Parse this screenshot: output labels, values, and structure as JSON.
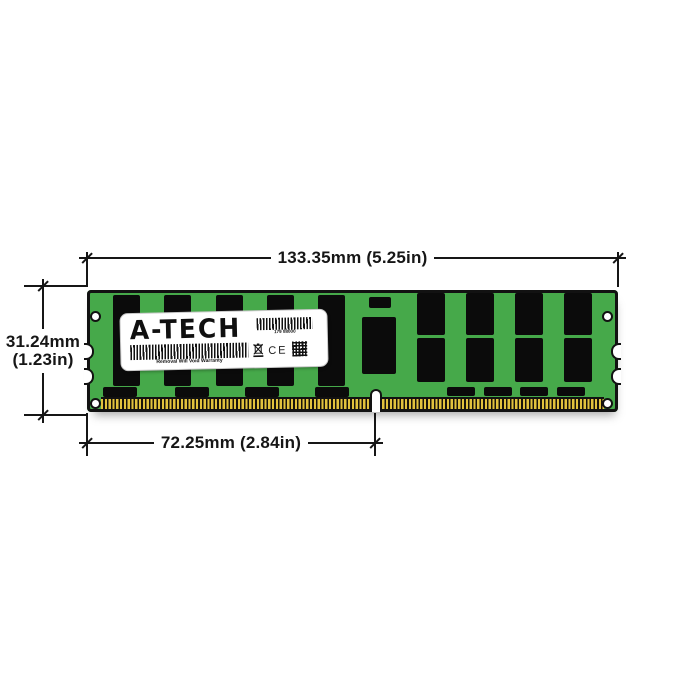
{
  "diagram": {
    "brand_logo": "A-TECH",
    "label": {
      "serial": "179 88000",
      "warning": "Removal Will Void Warranty",
      "ce_mark": "CE"
    },
    "dimensions": {
      "width_label": "133.35mm (5.25in)",
      "height_label_mm": "31.24mm",
      "height_label_in": "(1.23in)",
      "pin_offset_label": "72.25mm (2.84in)"
    },
    "colors": {
      "pcb_green": "#46a94a",
      "chip_black": "#0b0b0b",
      "pin_gold": "#e2c23d",
      "line_black": "#161616",
      "label_white": "#ffffff"
    }
  }
}
